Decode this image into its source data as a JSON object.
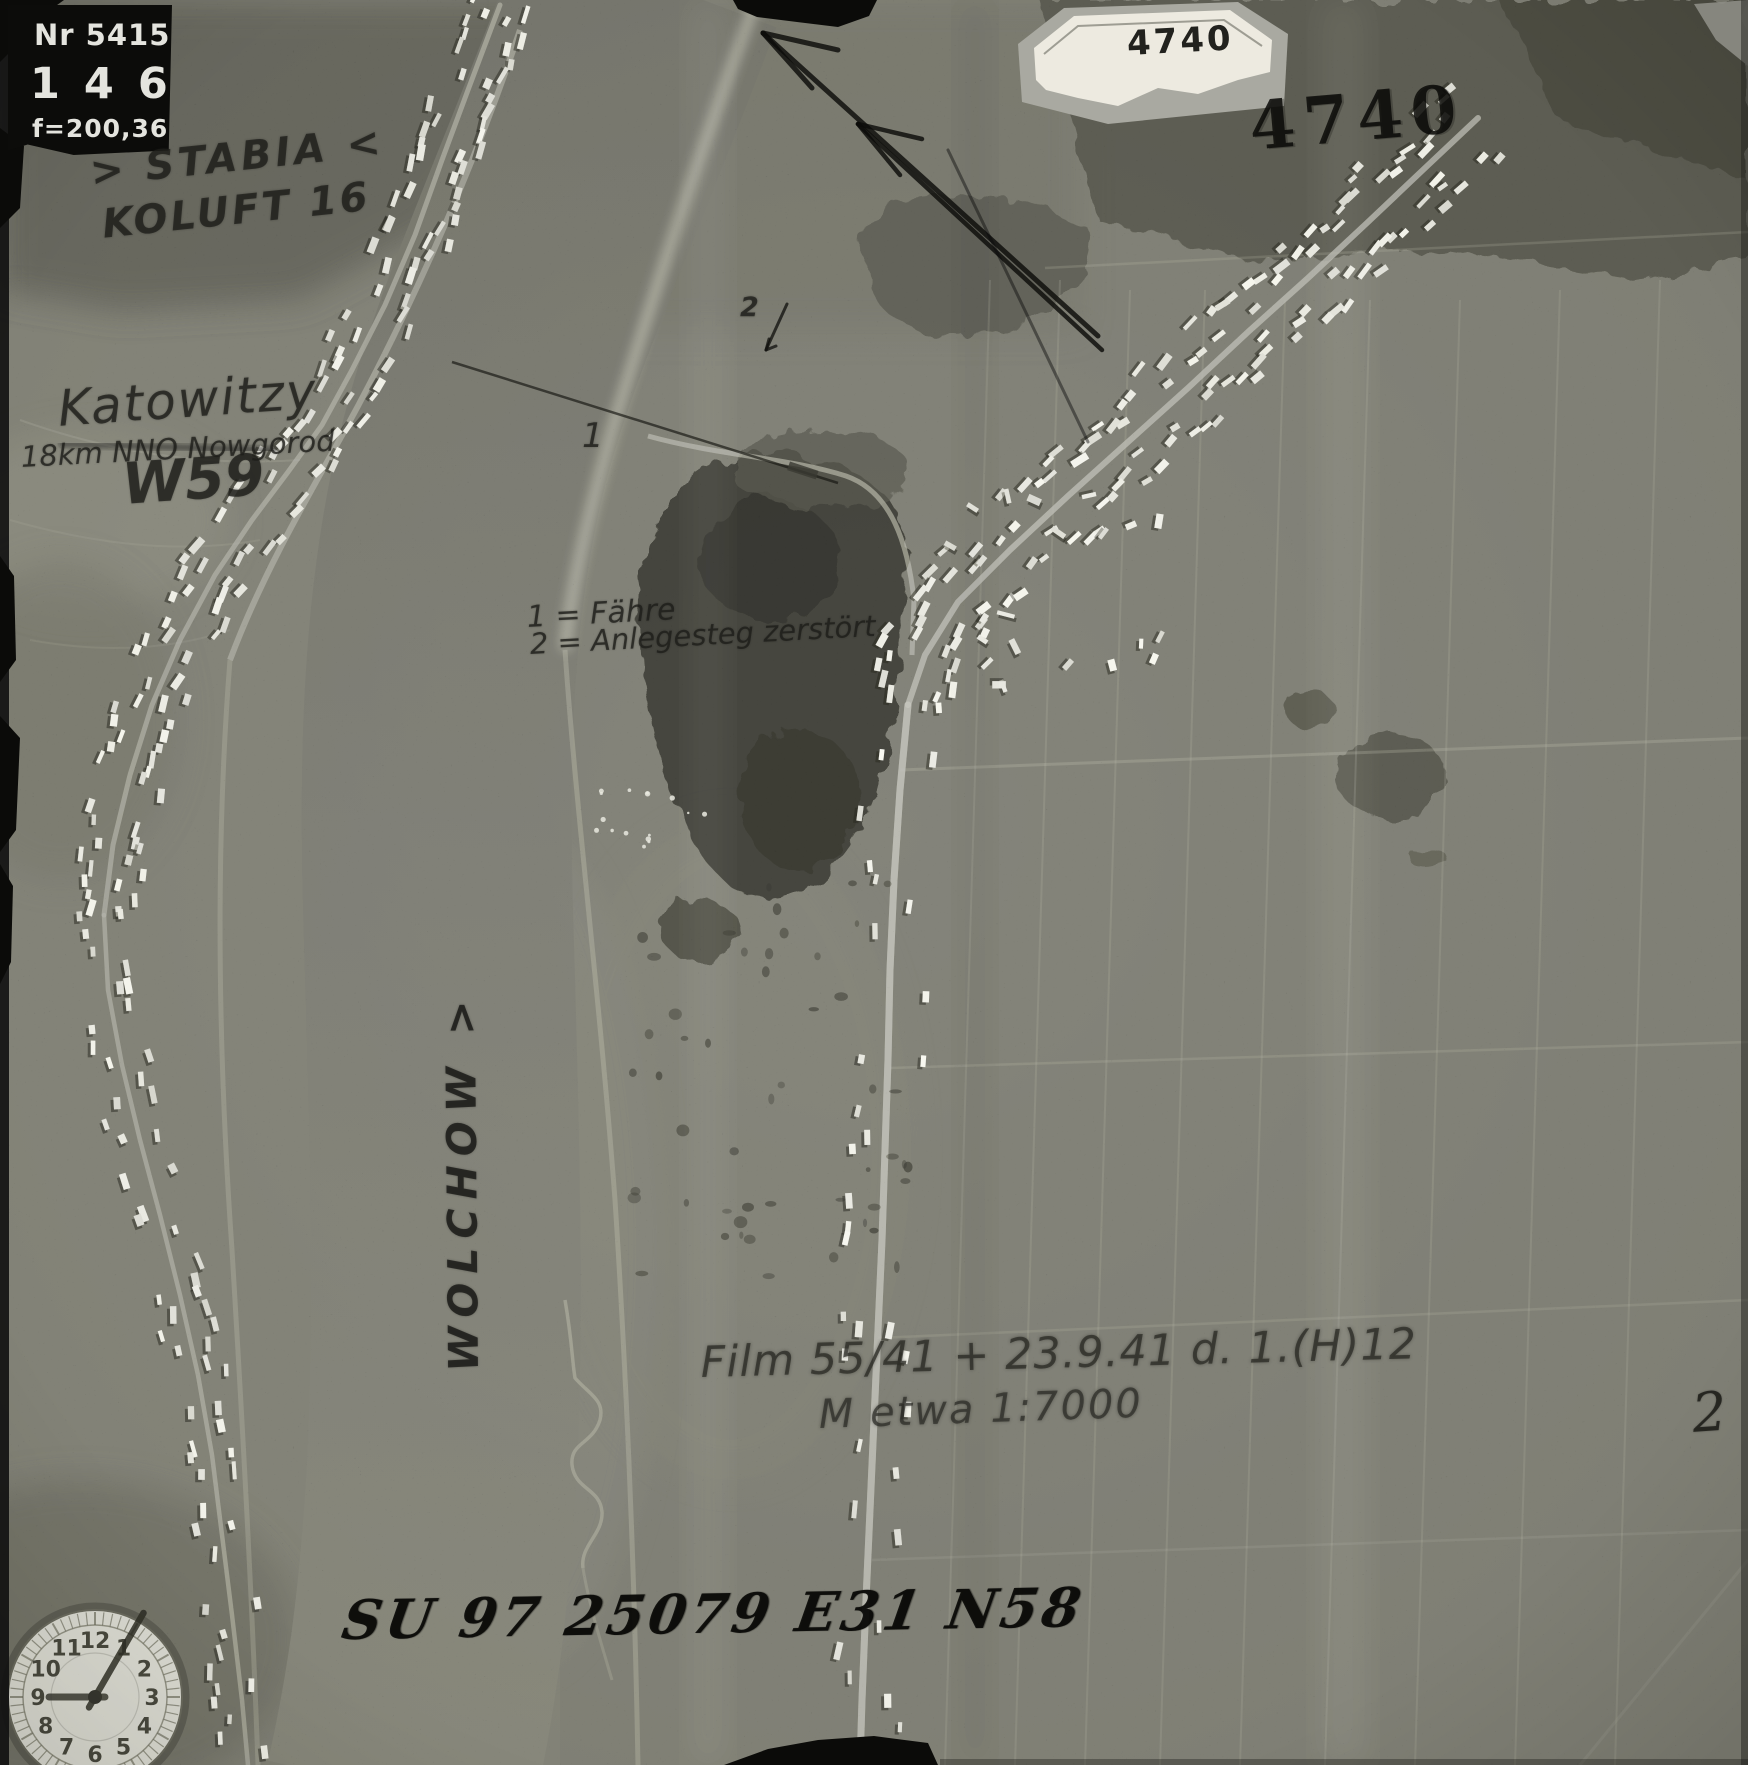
{
  "colors": {
    "paper_label": "#edeae0",
    "stamp_ink": "#0d0d0b",
    "pencil": "#262622",
    "plate_bg": "#0c0c0a",
    "plate_text": "#e4e4de"
  },
  "data_plate": {
    "photo_number": "Nr 5415",
    "frame_counter": "146",
    "focal_length": "f=200,36"
  },
  "labels": {
    "sortie_label": "4740",
    "sortie_stamp": "4740",
    "print_number": "2"
  },
  "handwriting": {
    "unit_line1": "> STABIA <",
    "unit_line2": "KOLUFT 16",
    "place_name": "Katowitzy",
    "place_detail": "18km NNO Nowgorod",
    "target_code": "W59",
    "marker_1": "1",
    "marker_2": "2",
    "legend_1": "1 = Fähre",
    "legend_2": "2 = Anlegesteg zerstört",
    "river_label": "WOLCHOW >",
    "film_info": "Film 55/41 + 23.9.41 d. 1.(H)12",
    "scale_info": "M etwa 1:7000",
    "grid_reference": "SU 97 25079 E31 N58"
  },
  "clock": {
    "numerals": [
      "1",
      "2",
      "3",
      "4",
      "5",
      "6",
      "7",
      "8",
      "9",
      "10",
      "11",
      "12"
    ],
    "hour_hand_points_to": 9,
    "minute_hand_points_to": 1
  }
}
